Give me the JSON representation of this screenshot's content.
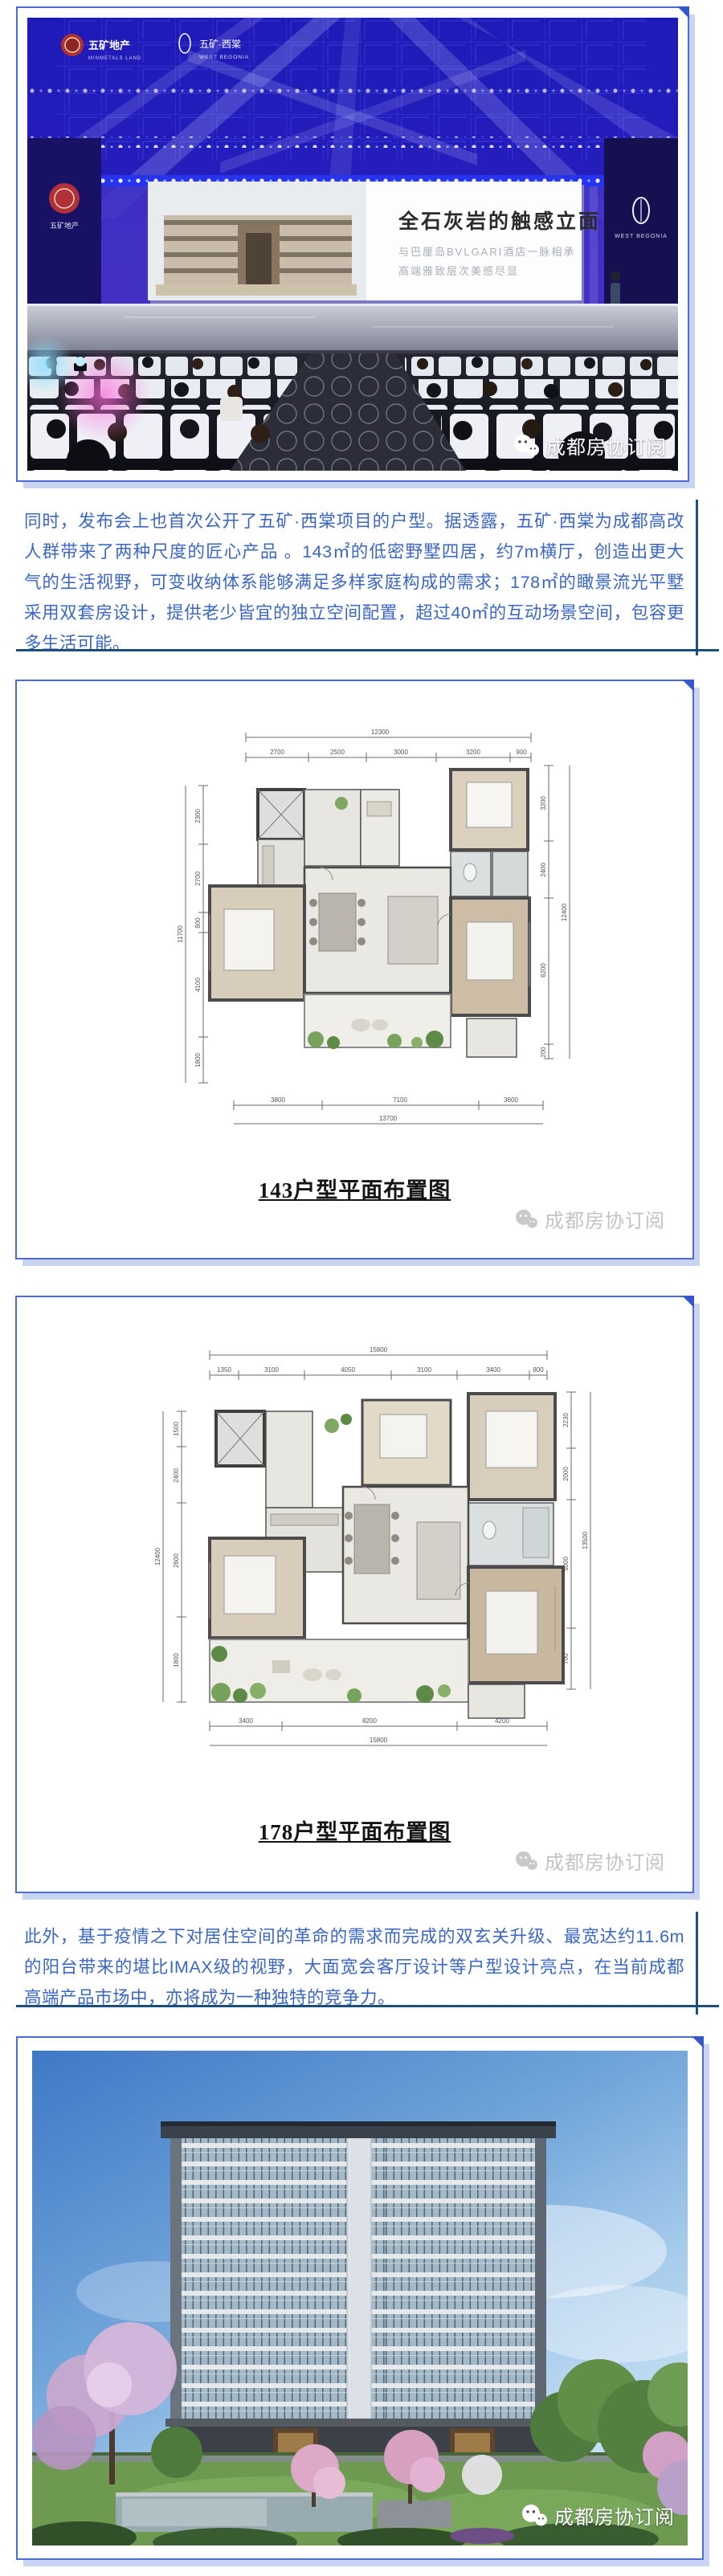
{
  "watermark": {
    "label": "成都房协订阅"
  },
  "hero": {
    "logo_minmetals_cn": "五矿地产",
    "logo_minmetals_en": "MINMETALS LAND",
    "logo_project_cn": "五矿·西棠",
    "logo_project_en": "WEST BEGONIA",
    "slide_title": "全石灰岩的触感立面",
    "slide_sub1": "与巴厘岛BVLGARI酒店一脉相承",
    "slide_sub2": "高端雅致层次美感尽显",
    "side_panel_en": "WEST BEGONIA",
    "side_panel_left_cn": "五矿地产"
  },
  "paragraphs": {
    "p1": "同时，发布会上也首次公开了五矿·西棠项目的户型。据透露，五矿·西棠为成都高改人群带来了两种尺度的匠心产品 。143㎡的低密野墅四居，约7m横厅，创造出更大气的生活视野，可变收纳体系能够满足多样家庭构成的需求；178㎡的瞰景流光平墅采用双套房设计，提供老少皆宜的独立空间配置，超过40㎡的互动场景空间，包容更多生活可能。",
    "p2": "此外，基于疫情之下对居住空间的革命的需求而完成的双玄关升级、最宽达约11.6m的阳台带来的堪比IMAX级的视野，大面宽会客厅设计等户型设计亮点，在当前成都高端产品市场中，亦将成为一种独特的竞争力。"
  },
  "plan143": {
    "caption": "143户型平面布置图",
    "dim_top_total": "12300",
    "dims_top": [
      "2700",
      "2500",
      "3000",
      "3200",
      "900"
    ],
    "dims_left": [
      "2300",
      "2700",
      "800",
      "4100",
      "1800"
    ],
    "dim_left_total": "11700",
    "dims_right": [
      "3200",
      "2400",
      "6200",
      "200"
    ],
    "dim_right_total": "12400",
    "dims_bottom": [
      "3800",
      "7100",
      "3600"
    ],
    "dim_bottom_total": "13700"
  },
  "plan178": {
    "caption": "178户型平面布置图",
    "dim_top_total": "15800",
    "dims_top": [
      "1350",
      "3100",
      "4050",
      "3100",
      "3400",
      "800"
    ],
    "dims_left": [
      "1500",
      "2400",
      "2600",
      "1800"
    ],
    "dim_left_total": "12400",
    "dims_right": [
      "2230",
      "2000",
      "5000",
      "700"
    ],
    "dim_right_total": "13500",
    "dims_bottom": [
      "3400",
      "8200",
      "4200"
    ],
    "dim_bottom_total": "15800"
  },
  "colors": {
    "frame_border": "#4b6bd5",
    "frame_shadow": "#c9d3f2",
    "rule": "#1d4f7c",
    "paragraph_text": "#3a66c4"
  }
}
